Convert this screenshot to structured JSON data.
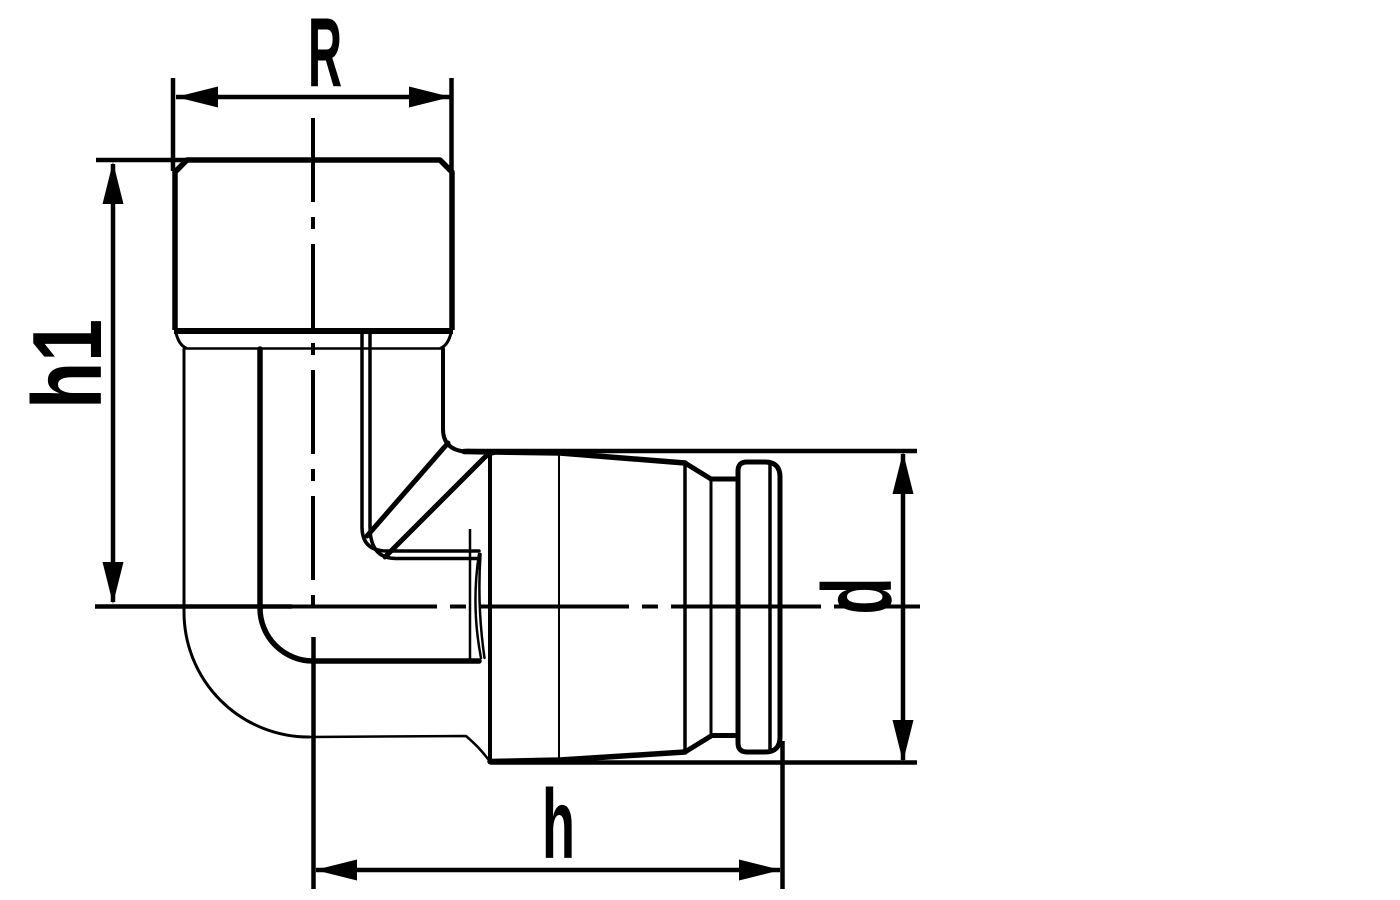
{
  "drawing": {
    "background": "#ffffff",
    "line_color": "#000000",
    "subject": "90-degree elbow pipe fitting, side view technical drawing",
    "dimensions": {
      "R": {
        "label": "R"
      },
      "h1": {
        "label": "h1"
      },
      "h": {
        "label": "h"
      },
      "d": {
        "label": "d"
      }
    }
  }
}
